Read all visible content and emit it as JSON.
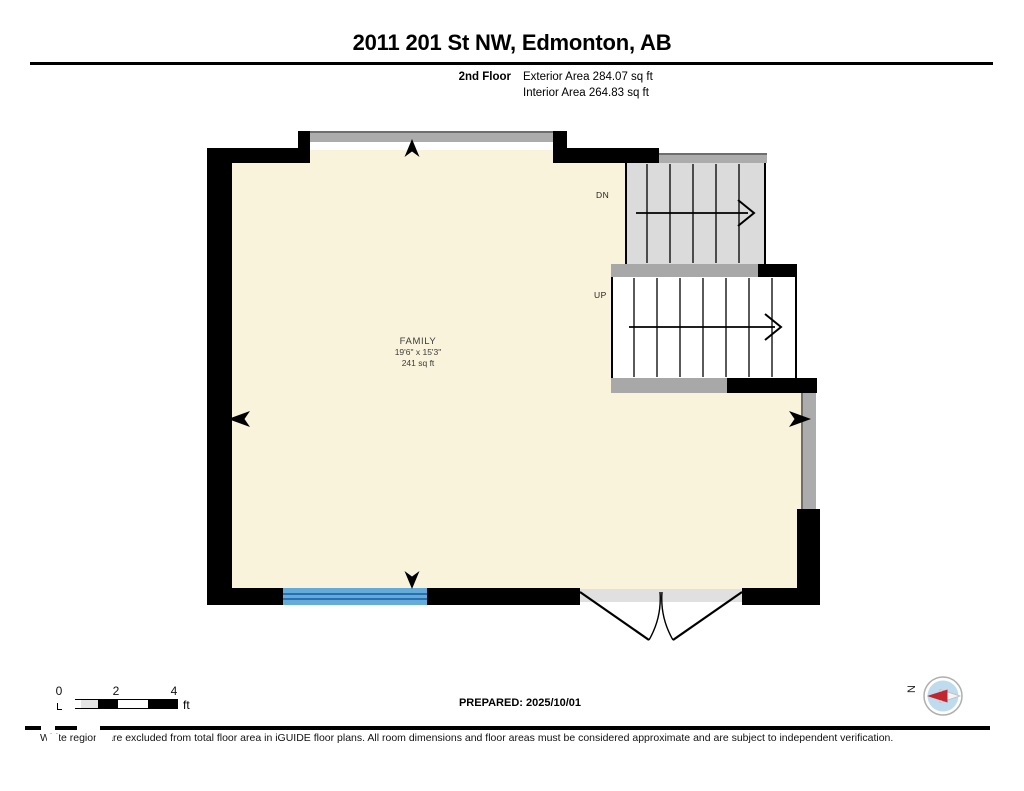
{
  "header": {
    "title": "2011 201 St NW, Edmonton, AB"
  },
  "floor_info": {
    "floor_label": "2nd Floor",
    "exterior_area": "Exterior Area 284.07 sq ft",
    "interior_area": "Interior Area 264.83 sq ft"
  },
  "plan": {
    "room": {
      "name": "FAMILY",
      "dimensions": "19'6\" x 15'3\"",
      "area": "241 sq ft"
    },
    "stairs": {
      "down": "DN",
      "up": "UP"
    },
    "colors": {
      "floor": "#FAF3DB",
      "wall": "#000000",
      "window": "#64ABD9",
      "window_line": "#2A6FB0",
      "stair_tread": "#DBDBDB",
      "landing": "#A8A8A8",
      "railing": "#ACACAC",
      "threshold": "#E0E0E0"
    }
  },
  "scale_bar": {
    "ticks": [
      "0",
      "2",
      "4"
    ],
    "unit": "ft"
  },
  "prepared_label": "PREPARED: 2025/10/01",
  "compass": {
    "north_label": "N",
    "needle_red": "#C2262E",
    "face": "#BFDCEE"
  },
  "footer": {
    "disclaimer": "White regions are excluded from total floor area in iGUIDE floor plans. All room dimensions and floor areas must be considered approximate and are subject to independent verification."
  }
}
